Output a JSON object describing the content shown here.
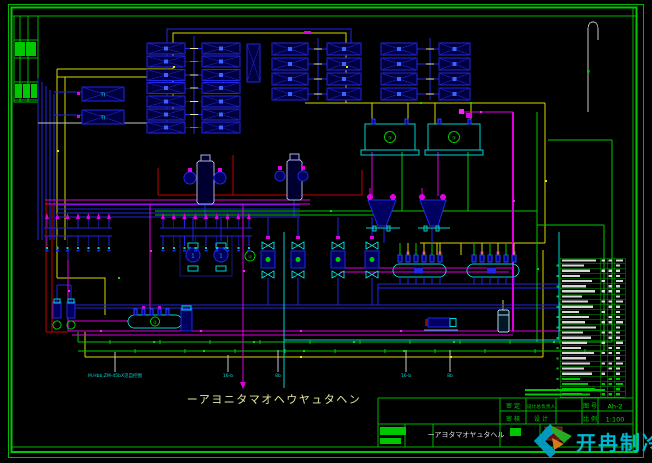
{
  "drawing": {
    "main_title": "ーアヨニタマオヘウヤュタヘン",
    "bottom_note": "M.Hbb,ZM-45bX见自控图",
    "pipe_labels": [
      "16-b",
      "8b",
      "16-b",
      "8b"
    ],
    "ahu_unit_label": "TI",
    "equipment_tags": {
      "cooling_tower": "③",
      "pump": "1",
      "pump_group": "①",
      "collector": "②"
    }
  },
  "title_block": {
    "approve_label": "审 定",
    "chief_designer_label": "设计总负责人",
    "drawing_no_label": "图 号",
    "drawing_no_value": "Ah-2",
    "review_label": "审 核",
    "design_label": "设 计",
    "scale_label": "比 例",
    "scale_value": "1:100",
    "drawing_name": "ーアヨタマオヤュタヘル"
  },
  "equipment_table": {
    "row_count": 27,
    "column_count": 4
  },
  "watermark": {
    "text": "开冉制冷",
    "text_color": "#00c0dc",
    "logo_colors": [
      "#00a0c8",
      "#28b428",
      "#e08018"
    ]
  },
  "palette": {
    "background": "#000000",
    "frame_green": "#00b400",
    "pipe_blue": "#2026e6",
    "pipe_cyan": "#00d2d2",
    "pipe_magenta": "#e000e0",
    "pipe_yellow": "#d8d800",
    "pipe_green": "#00c800",
    "pipe_red": "#c80000",
    "title_text": "#e6e6a0"
  }
}
